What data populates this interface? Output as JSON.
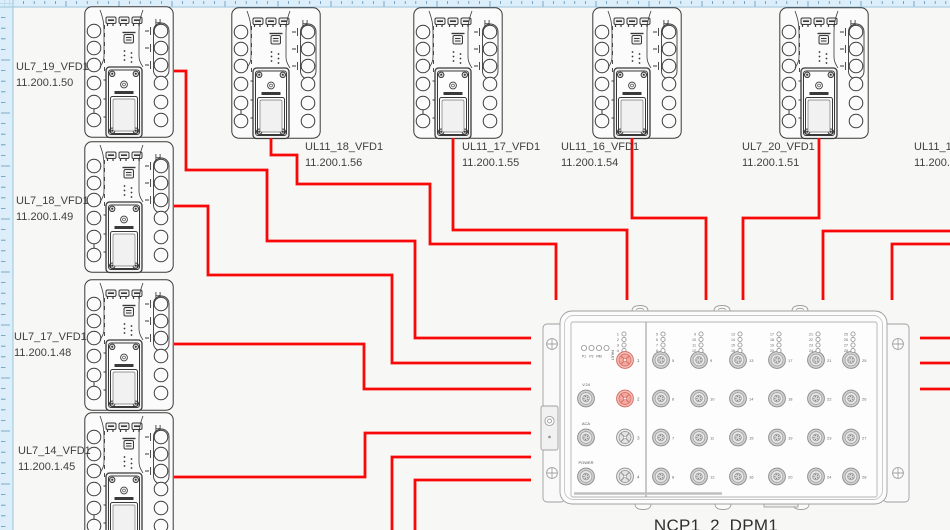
{
  "canvas": {
    "sheet_color": "#f7f7f6",
    "ruler_bg": "#dceef9",
    "ruler_tick": "#5f93b8",
    "ruler_border": "#9cc6de"
  },
  "cable": {
    "color": "#f90808",
    "width": 2.8
  },
  "devices": [
    {
      "name": "UL7_19_VFD1",
      "ip": "11.200.1.50",
      "x": 84,
      "y": 6
    },
    {
      "name": "UL7_18_VFD1",
      "ip": "11.200.1.49",
      "x": 84,
      "y": 141
    },
    {
      "name": "UL7_17_VFD1",
      "ip": "11.200.1.48",
      "x": 84,
      "y": 279
    },
    {
      "name": "UL7_14_VFD1",
      "ip": "11.200.1.45",
      "x": 84,
      "y": 412
    },
    {
      "name": "UL11_18_VFD1",
      "ip": "11.200.1.56",
      "x": 231,
      "y": 7
    },
    {
      "name": "UL11_17_VFD1",
      "ip": "11.200.1.55",
      "x": 413,
      "y": 7
    },
    {
      "name": "UL11_16_VFD1",
      "ip": "11.200.1.54",
      "x": 592,
      "y": 7
    },
    {
      "name": "UL7_20_VFD1",
      "ip": "11.200.1.51",
      "x": 779,
      "y": 7
    },
    {
      "name": "UL11_14",
      "ip": "11.200.1",
      "x": null,
      "y": null
    }
  ],
  "switch": {
    "name": "NCP1_2_DPM1",
    "status_leds": [
      "P1",
      "P2",
      "RM",
      "FAULT"
    ],
    "aux_ports": [
      "V.24",
      "ACA",
      "POWER"
    ],
    "led_bank_left": [
      "1",
      "2",
      "3",
      "4"
    ],
    "port_numbers_left": [
      "1",
      "2",
      "3",
      "4"
    ],
    "highlighted_ports": [
      "1",
      "2"
    ],
    "port_columns": [
      [
        "5",
        "6",
        "7",
        "8"
      ],
      [
        "9",
        "10",
        "11",
        "12"
      ],
      [
        "13",
        "14",
        "15",
        "16"
      ],
      [
        "17",
        "18",
        "19",
        "20"
      ],
      [
        "21",
        "22",
        "23",
        "24"
      ],
      [
        "25",
        "26",
        "27",
        "28"
      ]
    ]
  },
  "cables": [
    {
      "name": "UL7_19_VFD1-to-switch",
      "points": "174,71 186,71 186,170 267,170 267,241 415,241 415,338 531,338"
    },
    {
      "name": "UL7_18_VFD1-to-switch",
      "points": "174,206 208,206 208,275 392,275 392,363 531,363"
    },
    {
      "name": "UL7_17_VFD1-to-switch",
      "points": "174,344 364,344 364,389 531,389"
    },
    {
      "name": "UL7_14_VFD1-to-switch",
      "points": "174,477 365,477 365,433 531,433"
    },
    {
      "name": "UL11_18_VFD1-to-switch",
      "points": "271,138 271,155 297,155 297,184 430,184 430,244 556,244 556,300"
    },
    {
      "name": "UL11_17_VFD1-to-switch",
      "points": "453,138 453,230 627,230 627,300"
    },
    {
      "name": "UL11_16_VFD1-to-switch",
      "points": "632,138 632,218 706,218 706,300"
    },
    {
      "name": "UL7_20_VFD1-to-switch",
      "points": "819,138 819,218 743,218 743,300"
    },
    {
      "name": "offscreen-right-to-switch-a",
      "points": "950,231 823,231 823,300"
    },
    {
      "name": "offscreen-right-to-switch-b",
      "points": "950,244 892,244 892,300"
    },
    {
      "name": "offscreen-bottom-to-switch-a",
      "points": "392,532 392,457 531,457"
    },
    {
      "name": "offscreen-bottom-to-switch-b",
      "points": "415,532 415,480 531,480"
    },
    {
      "name": "switch-right-stub-1",
      "points": "920,338 950,338"
    },
    {
      "name": "switch-right-stub-2",
      "points": "920,363 950,363"
    },
    {
      "name": "switch-right-stub-3",
      "points": "920,389 950,389"
    }
  ]
}
